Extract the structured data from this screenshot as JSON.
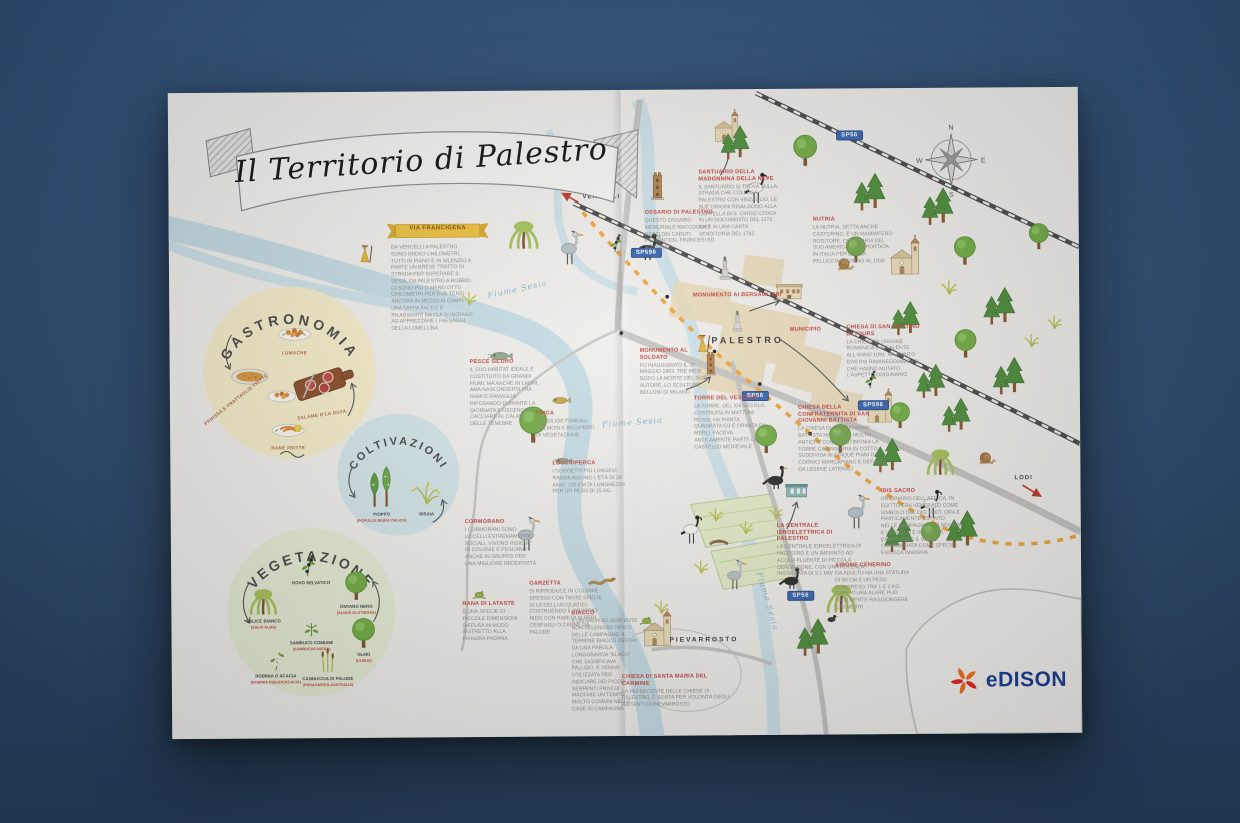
{
  "poster": {
    "title": "Il Territorio di Palestro"
  },
  "brand": {
    "name": "Edison",
    "wordmark": "eDISON",
    "blue": "#1b3f94",
    "orange": "#f36f21",
    "red": "#e1251b"
  },
  "via_francigena": {
    "title": "VIA FRANCIGENA",
    "body": "DA VERCELLI A PALESTRO SONO UNDICI CHILOMETRI, TUTTI IN PIANO E IN SILENZIO A PARTE UN BREVE TRATTO DI STRADA PER SUPERARE IL SESIA. DA PALESTRO A ROBBIO CI SONO PIÙ O MENO OTTO CHILOMETRI PER DUE TERZI ANCORA IN MEZZO AI CAMPI. UNA TAPPA FACILE E RILASSANTE DA CUI SI INIZIANO AD APPREZZARE I PAESAGGI DELLA LOMELLINA"
  },
  "circles": [
    {
      "id": "gastronomia",
      "title": "GASTRONOMIA",
      "items": [
        {
          "label": "LUMACHE"
        },
        {
          "label": "PANISSA E FRATTAGLIE FRITTE"
        },
        {
          "label": "SALAME D'LA DUJA"
        },
        {
          "label": "RANE FRITTE"
        }
      ]
    },
    {
      "id": "coltivazioni",
      "title": "COLTIVAZIONI",
      "items": [
        {
          "label": "PIOPPO",
          "latin": "(POPULUS NIGRA ITALICA)"
        },
        {
          "label": "RISAIA",
          "latin": ""
        }
      ]
    },
    {
      "id": "vegetazione",
      "title": "VEGETAZIONE",
      "items": [
        {
          "label": "ROVO SELVATICO",
          "latin": "(RUBUS ULMIFOLIUS)"
        },
        {
          "label": "ONTANO NERO",
          "latin": "(ALNUS GLUTINOSA)"
        },
        {
          "label": "SALICE BIANCO",
          "latin": "(SALIX ALBA)"
        },
        {
          "label": "SAMBUCO COMUNE",
          "latin": "(SAMBUCUS NIGRA)"
        },
        {
          "label": "OLMO",
          "latin": "(ULMUS)"
        },
        {
          "label": "ROBINIA O ACACIA",
          "latin": "(ROBINIA PSEUDOACACIA)"
        },
        {
          "label": "CANNUCCIA DI PALUDE",
          "latin": "(PHRAGMITES AUSTRALIS)"
        }
      ]
    }
  ],
  "notes": [
    {
      "id": "pesce-siluro",
      "title": "PESCE SILURO",
      "body": "IL SUO HABITAT IDEALE È COSTITUITO DA GRANDI FIUMI, MA ANCHE IN LAGHI. AMA NASCONDERSI TRA RAMI E RAMAGLIA, RIPOSANDO DURANTE LA GIORNATA E USCENDO A CACCIARE AL CALARE DELLE TENEBRE"
    },
    {
      "id": "tinca",
      "title": "TINCA",
      "body": "PREDILIGE FONDALI MELMOSI E RICOPERTI DI VEGETAZIONE"
    },
    {
      "id": "luccioperca",
      "title": "LUCCIOPERCA",
      "body": "I SOGGETTI PIÙ LONGEVI RAGGIUNGONO L'ETÀ DI 20 ANNI, 130 CM DI LUNGHEZZA PER UN PESO DI 15 KG"
    },
    {
      "id": "cormorano",
      "title": "CORMORANO",
      "body": "I CORMORANI SONO UCCELLI ESTREMAMENTE SOCIALI, VIVONO INSIEME IN COLONIE E PESCANO ANCHE IN GRUPPO PER UNA MIGLIORE REDDITIVITÀ"
    },
    {
      "id": "garzetta",
      "title": "GARZETTA",
      "body": "SI RIPRODUCE IN COLONIE, SPESSO CON TANTE SPECIE DI UCCELLI ACQUATICI, COSTRUENDO IL PROPRIO NIDO CON RAMI DI ALBERI, CESPUGLI O CANNE DA PALUDE"
    },
    {
      "id": "rana-di-lataste",
      "title": "RANA DI LATASTE",
      "body": "È UNA SPECIE DI PICCOLE DIMENSIONI DIFFUSA IN MODO RISTRETTO ALLA PIANURA PADANA"
    },
    {
      "id": "biacco",
      "title": "BIACCO",
      "body": "È UN GROSSO SERPENTE NON VELENOSO TIPICO DELLE CAMPAGNE. IL TERMINE BIACCO DERIVA DA UNA PAROLA LONGOBARDA \"BLACH\" CHE SIGNIFICAVA PALLIDO, E VENIVA UTILIZZATA PER INDICARE DEI PICCOLI SERPENTI PRIVI DI MACCHIE UN TEMPO MOLTO COMUNI NELLE CASE DI CAMPAGNA"
    },
    {
      "id": "chiesa-carmine",
      "title": "CHIESA DI SANTA MARIA DEL CARMINE",
      "body": "LA PIÙ RECENTE DELLE CHIESE DI PALESTRO, È SORTA PER VOLONTÀ DEGLI ABITANTI DI PIEVARROSTO"
    },
    {
      "id": "ossario",
      "title": "OSSARIO DI PALESTRO",
      "body": "QUESTO OSSARIO MEMORIALE RACCOGLIE I RESTI DEI CADUTI PIEMONTESI, FRANCESI ED AUSTRIACI"
    },
    {
      "id": "santuario",
      "title": "SANTUARIO DELLA MADONNINA DELLA NEVE",
      "body": "IL SANTUARIO SI TROVA SULLA STRADA CHE COLLEGA PALESTRO CON VINZAGLIO. LE SUE ORIGINI RISALGONO ALLA CAPPELLA DI S. OVIDIO CITATA IN UN DOCUMENTO DEL 1275 MA È IN UNA CARTA VENDITORIA DEL 1762"
    },
    {
      "id": "nutria",
      "title": "NUTRIA",
      "body": "LA NUTRIA, DETTA ANCHE CASTORINO, È UN MAMMIFERO RODITORE, ORIGINARIA DEL SUD AMERICA, FU IMPORTATA IN ITALIA PER LA SUA PELLICCIA INTORNO AL 1930"
    },
    {
      "id": "san-martino",
      "title": "CHIESA DI SAN MARTINO DI TOURS",
      "body": "LA CHIESA DI ORIGINE ROMANICA È RISALENTE ALL'ANNO 1091. HA SUBITO DIVERSI RIMANEGGIAMENTI CHE HANNO MUTATO L'ASPETTO ORIGINARIO"
    },
    {
      "id": "monumento-bersaglieri",
      "title": "MONUMENTO AI BERSAGLIERI",
      "body": ""
    },
    {
      "id": "municipio",
      "title": "MUNICIPIO",
      "body": ""
    },
    {
      "id": "monumento-soldato",
      "title": "MONUMENTO AL SOLDATO",
      "body": "FU INAUGURATO IL 30 MAGGIO 1863, TRE MESI DOPO LA MORTE DEL SUO AUTORE, LO SCULTORE BELLONI DI MILANO"
    },
    {
      "id": "torre-vescovo",
      "title": "TORRE DEL VESCOVO",
      "body": "LA TORRE, DEL XIII SECOLO, COSTRUITA IN MATTONI ROSSI, HA PIANTA QUADRATA ED È ORNATA DA MERLI. FACEVA ANTICAMENTE PARTE DEL CASTELLO MEDIEVALE"
    },
    {
      "id": "confraternita",
      "title": "CHIESA DELLA CONFRATERNITA DI SAN GIOVANNI BATTISTA",
      "body": "LA CHIESA DI SAN GIOVANNI BATTISTA HA ORIGINI MOLTO ANTICHE COME TESTIMONIA LA TORRE CAMPANARIA IN COTTO SUDDIVISA IN CINQUE PIANI DA CORNICI MARCAPIANO E DEFINITA DA LESENE LATERALI"
    },
    {
      "id": "centrale",
      "title": "LA CENTRALE IDROELETTRICA DI PALESTRO",
      "body": "LA CENTRALE IDROELETTRICA DI PALESTRO È UN IMPIANTO AD ACQUA FLUENTE DI PICCOLA DERIVAZIONE, CON UNA POTENZA INSTALLATA DI 3,1 MW"
    },
    {
      "id": "ibis-sacro",
      "title": "IBIS SACRO",
      "body": "ORIGINARIO DELL'AFRICA, IN EGITTO ERA VENERATO COME SIMBOLO DEL DIO THOT, ORA È PRATICAMENTE ESTINTO. NELLE CAMPAGNE TRA NOVARA E VERCELLI È IN RAPIDA ESPANSIONE E VIENE CONSIDERATA COME SPECIE ESOTICA INVASIVA"
    },
    {
      "id": "airone-cenerino",
      "title": "AIRONE CENERINO",
      "body": "DA ADULTO HA UNA STATURA DI 90 CM E UN PESO COMPRESO TRA 1 E 2 KG. L'APERTURA ALARE PUÒ FACILMENTE RAGGIUNGERE 1,70 METRI"
    }
  ],
  "labels": {
    "towns": [
      {
        "id": "palestro",
        "text": "PALESTRO"
      },
      {
        "id": "pievarrosto",
        "text": "PIEVARROSTO"
      }
    ],
    "directions": [
      {
        "id": "vercelli",
        "text": "VERCELLI"
      },
      {
        "id": "lodi",
        "text": "LODI"
      }
    ],
    "rivers": [
      "Fiume Sesia",
      "Fiume Sesia",
      "Fiume Sesia"
    ],
    "road_badges": [
      "SP596",
      "SP56",
      "SP596",
      "SP56",
      "SP56"
    ],
    "compass": {
      "n": "N",
      "e": "E",
      "s": "S",
      "w": "W"
    }
  },
  "icons": [
    "compass-rose-icon",
    "edison-sun-icon",
    "conifer-trees-icon",
    "round-tree-icon",
    "willow-tree-icon",
    "grass-tuft-icon",
    "heron-icon",
    "cormorant-icon",
    "ibis-icon",
    "duck-icon",
    "snail-icon",
    "snake-icon",
    "frog-icon",
    "fish-icon",
    "blackberry-branch-icon",
    "pilgrim-icon",
    "church-icon",
    "brick-tower-icon",
    "monument-icon",
    "town-hall-icon",
    "power-plant-icon",
    "bridge-icon"
  ],
  "colors": {
    "background": "#2f4e74",
    "paper": "#f2f1ee",
    "river": "#c7dde6",
    "road": "#c6c5c2",
    "railway": "#4c4c4c",
    "francigena": "#f0a73e",
    "heading_red": "#c34a42",
    "body_grey": "#8f8f8c",
    "badge_blue": "#3a67b0"
  }
}
